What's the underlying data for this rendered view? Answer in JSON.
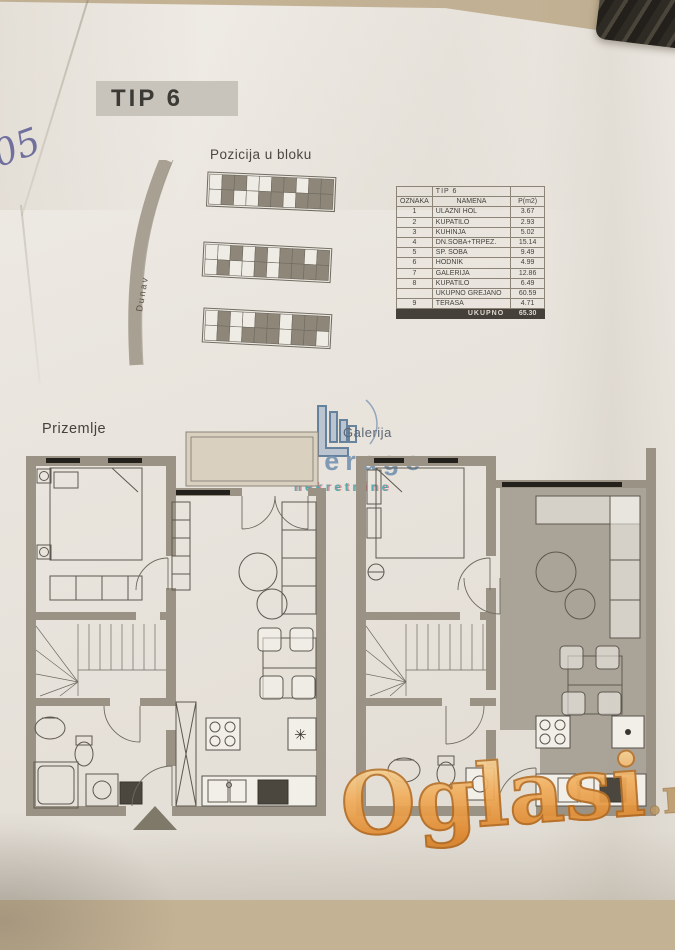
{
  "page": {
    "handwritten_note": "05"
  },
  "header": {
    "type_label": "TIP 6"
  },
  "position_block": {
    "title": "Pozicija u bloku",
    "river_label": "Dunav",
    "strips": [
      {
        "top": [
          0,
          1,
          1,
          0,
          0,
          1,
          1,
          0,
          1,
          1
        ],
        "bottom": [
          0,
          1,
          0,
          0,
          1,
          1,
          0,
          1,
          1,
          1
        ]
      },
      {
        "top": [
          0,
          0,
          1,
          0,
          1,
          0,
          1,
          1,
          0,
          1
        ],
        "bottom": [
          0,
          1,
          0,
          0,
          1,
          0,
          1,
          1,
          1,
          1
        ]
      },
      {
        "top": [
          0,
          1,
          0,
          0,
          1,
          1,
          0,
          1,
          1,
          1
        ],
        "bottom": [
          0,
          1,
          0,
          1,
          1,
          1,
          0,
          1,
          1,
          0
        ]
      }
    ]
  },
  "area_table": {
    "title": "TIP 6",
    "columns": [
      "OZNAKA",
      "NAMENA",
      "P(m2)"
    ],
    "rows": [
      [
        "1",
        "ULAZNI HOL",
        "3.67"
      ],
      [
        "2",
        "KUPATILO",
        "2.93"
      ],
      [
        "3",
        "KUHINJA",
        "5.02"
      ],
      [
        "4",
        "DN.SOBA+TRPEZ.",
        "15.14"
      ],
      [
        "5",
        "SP. SOBA",
        "9.49"
      ],
      [
        "6",
        "HODNIK",
        "4.99"
      ],
      [
        "7",
        "GALERIJA",
        "12.86"
      ],
      [
        "8",
        "KUPATILO",
        "6.49"
      ],
      [
        "",
        "UKUPNO GREJANO",
        "60.59"
      ],
      [
        "9",
        "TERASA",
        "4.71"
      ]
    ],
    "footer": {
      "label": "UKUPNO",
      "value": "65.30"
    }
  },
  "floor_plans": {
    "ground_floor_label": "Prizemlje",
    "freezer_symbol": "✳"
  },
  "watermarks": {
    "agency": {
      "gallery": "Galerija",
      "brand": "Leverage",
      "subtitle": "nekretnine"
    },
    "portal": {
      "name": "Oglasi",
      "tld": ".rs"
    }
  },
  "colors": {
    "accent_blue": "#7792ae",
    "accent_teal": "#3da5ab",
    "portal_orange": "#e08a2e",
    "wall_gray": "#9a9284",
    "highlight_fill": "#a59e92"
  }
}
